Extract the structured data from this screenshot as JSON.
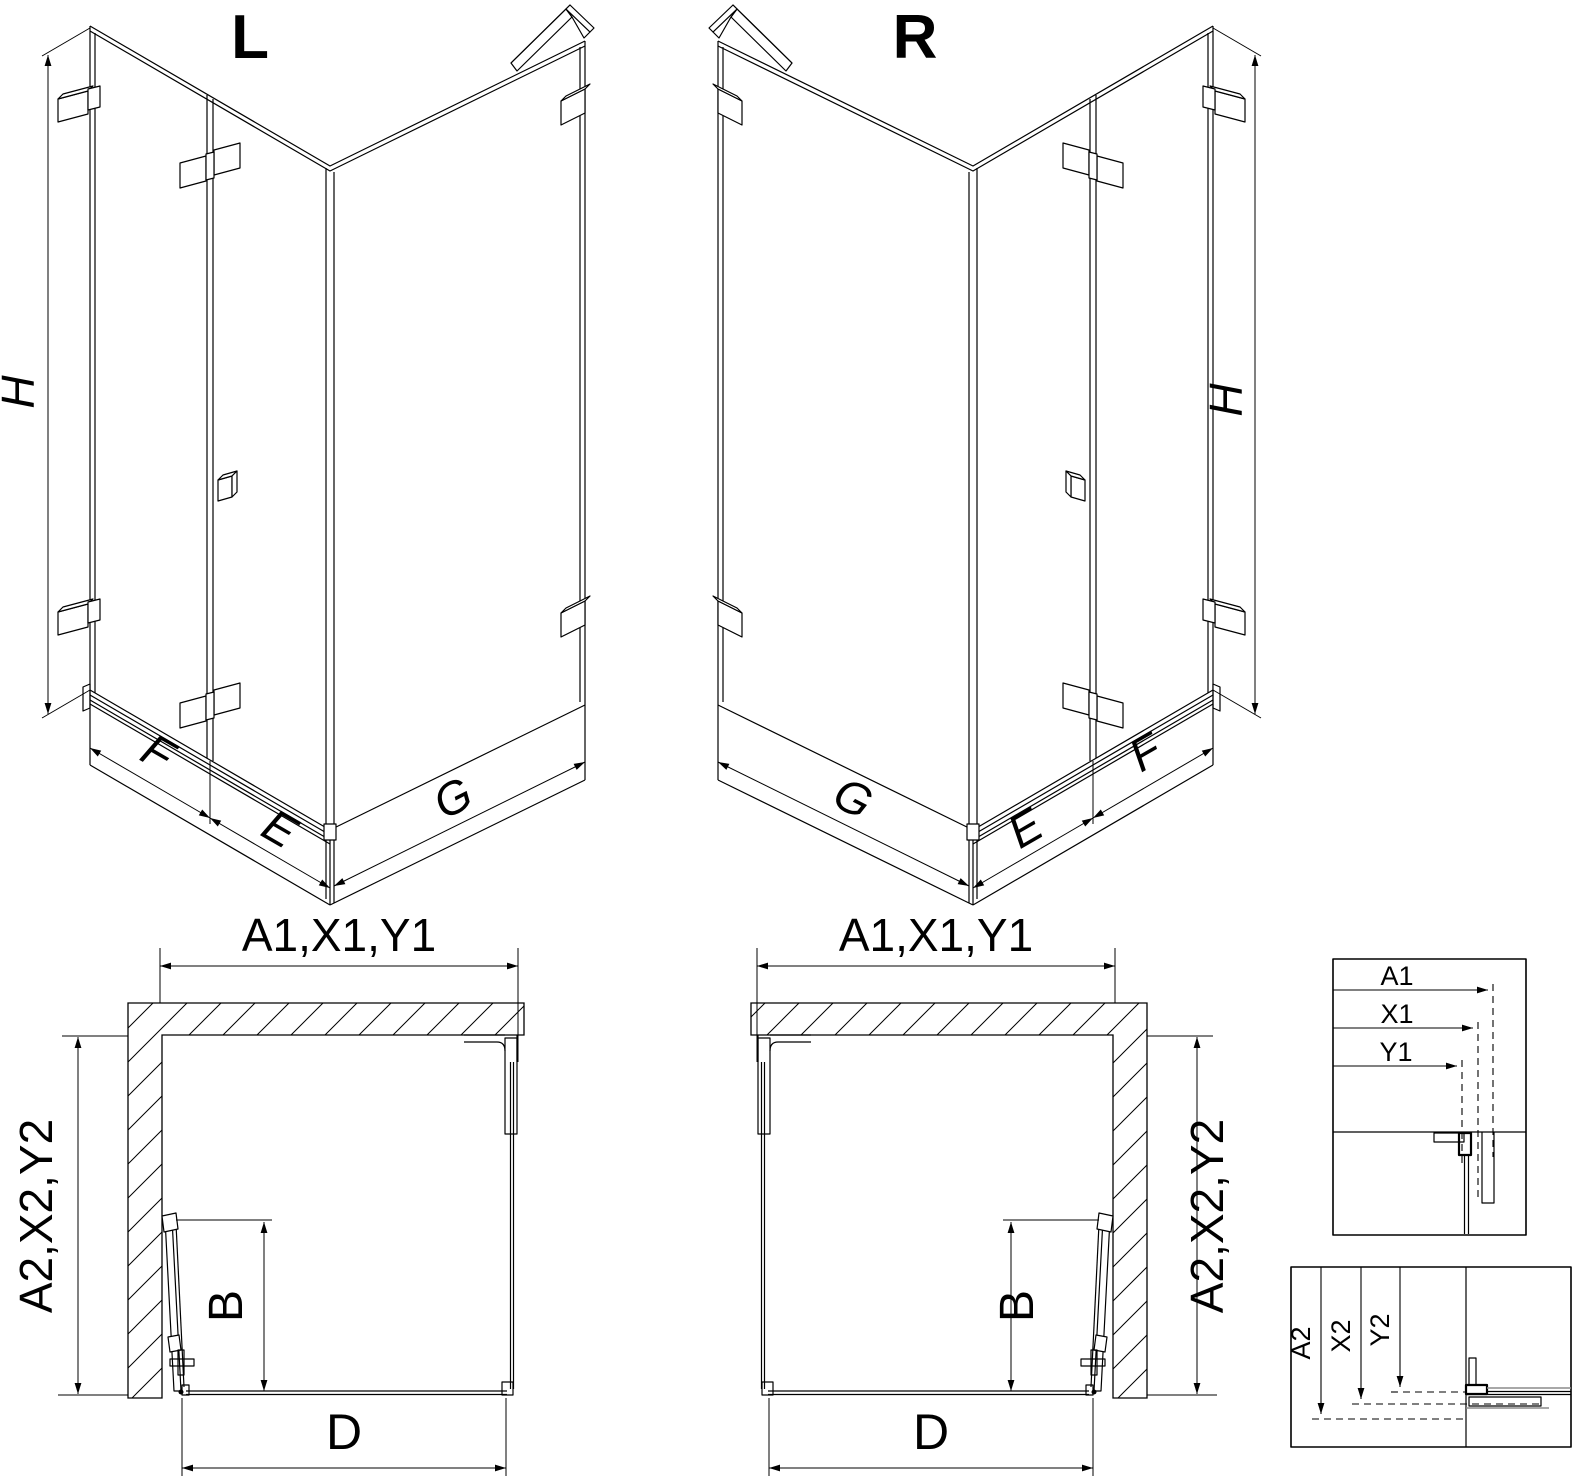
{
  "drawing": {
    "background": "#ffffff",
    "line_color": "#000000",
    "accent_gray": "#8c8c8c",
    "iso_views": [
      {
        "variant_label": "L",
        "height_dim": "H",
        "door_panel_dim": "F",
        "inner_panel_dim": "E",
        "side_panel_dim": "G"
      },
      {
        "variant_label": "R",
        "height_dim": "H",
        "door_panel_dim": "F",
        "inner_panel_dim": "E",
        "side_panel_dim": "G"
      }
    ],
    "plan_views": [
      {
        "top_dim": "A1,X1,Y1",
        "depth_dim": "A2,X2,Y2",
        "entry_dim": "B",
        "front_dim": "D"
      },
      {
        "top_dim": "A1,X1,Y1",
        "depth_dim": "A2,X2,Y2",
        "entry_dim": "B",
        "front_dim": "D"
      }
    ],
    "detail_views": [
      {
        "dims": [
          "A1",
          "X1",
          "Y1"
        ]
      },
      {
        "dims": [
          "A2",
          "X2",
          "Y2"
        ]
      }
    ]
  }
}
